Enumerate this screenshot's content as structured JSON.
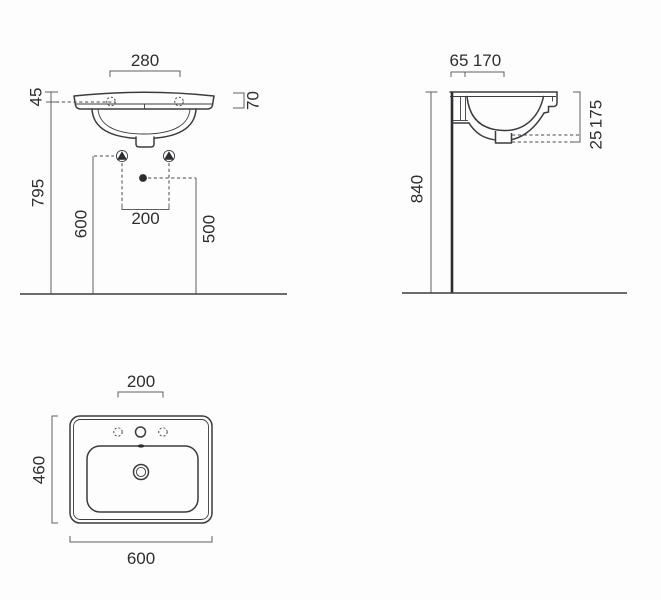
{
  "title": "Washbasin dimensional technical drawing",
  "colors": {
    "background": "#fdfdfd",
    "outline": "#3a3c3f",
    "dimension_line": "#5d5f62",
    "text": "#2c2e30"
  },
  "front_view": {
    "name": "front elevation",
    "dims": {
      "tap_centres": "280",
      "rim_front_height": "45",
      "rim_total_height": "70",
      "overall_height": "795",
      "fixing_height": "600",
      "fixing_centres": "200",
      "siphon_height": "500"
    }
  },
  "side_view": {
    "name": "side section",
    "dims": {
      "fixing_from_wall": "65",
      "tap_from_wall": "170",
      "outlet_gap": "25",
      "outlet_depth": "175",
      "rim_height": "840"
    }
  },
  "top_view": {
    "name": "plan view",
    "dims": {
      "tap_centres": "200",
      "depth": "460",
      "width": "600"
    }
  }
}
